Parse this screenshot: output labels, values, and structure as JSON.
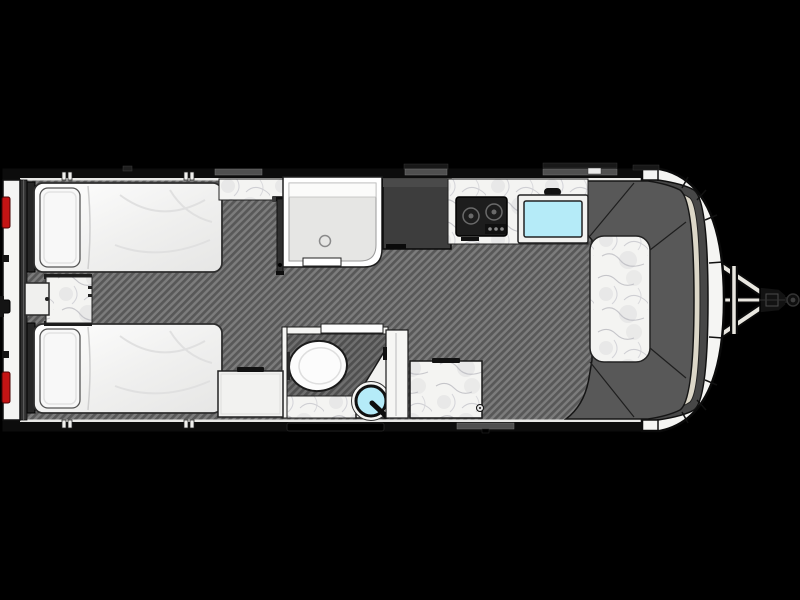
{
  "scene": {
    "type": "floor-plan",
    "subject": "Top-down floor plan of a travel trailer with twin beds, shower, wet bath, kitchenette and front dinette",
    "orientation": "rear bumper with tail lights on the left, A-frame hitch coupler on the right"
  },
  "palette": {
    "bg": "#000000",
    "shell_black": "#0c0c0c",
    "wall_white": "#f5f5f3",
    "inner_line": "#e8e8e6",
    "floor_light": "#7c7c7c",
    "floor_dark": "#585858",
    "marble_base": "#f4f4f2",
    "furniture_white": "#f2f2f0",
    "sofa_gray": "#585858",
    "nose_dark_band": "#474747",
    "nose_band_beige": "#dcd7c8",
    "wardrobe_gray": "#3d3d3d",
    "stove_black": "#1d1d1d",
    "sink_cyan": "#b5ebf8",
    "tail_light_red": "#c41414",
    "shower_floor": "#e6e6e4",
    "track_gray": "#2f2f2f"
  },
  "fixtures": {
    "bed_top": "twin bed (top, rear)",
    "bed_bottom": "twin bed (bottom, rear)",
    "nightstand": "center nightstand with marble top",
    "shower": "shower stall with drain",
    "wardrobe": "wardrobe / refrigerator cabinet",
    "stove": "two-burner cooktop",
    "kitchen_sink": "kitchen sink",
    "bathroom": "wet bath with toilet and corner basin",
    "dinette": "front U-shaped dinette with marble table",
    "hitch": "A-frame tongue with coupler and ball"
  }
}
